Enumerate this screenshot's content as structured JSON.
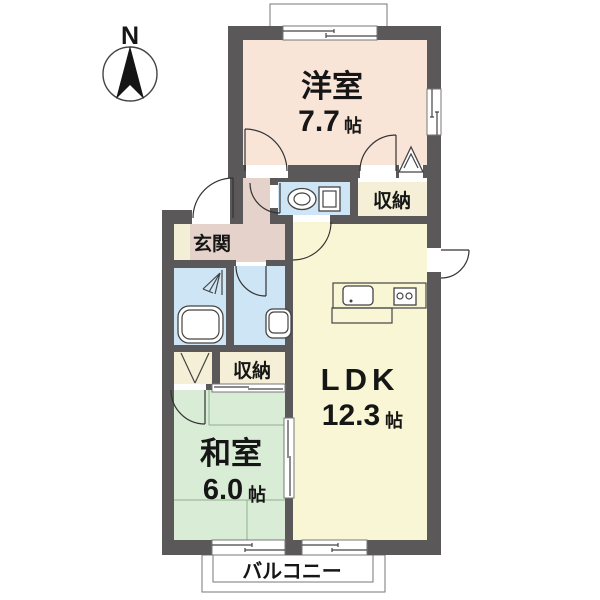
{
  "compass": {
    "label": "N"
  },
  "rooms": {
    "western": {
      "name": "洋室",
      "area": "7.7",
      "unit": "帖"
    },
    "ldk": {
      "name": "LDK",
      "area": "12.3",
      "unit": "帖"
    },
    "japanese": {
      "name": "和室",
      "area": "6.0",
      "unit": "帖"
    },
    "entrance": {
      "name": "玄関"
    },
    "storage_upper": {
      "name": "収納"
    },
    "storage_lower": {
      "name": "収納"
    },
    "balcony": {
      "name": "バルコニー"
    }
  },
  "colors": {
    "wall": "#5a5858",
    "western_room": "#f9e5d8",
    "hallway": "#e5d2ca",
    "entrance_step": "#f3eed6",
    "wet_area": "#cde5f4",
    "storage": "#f4efd6",
    "ldk": "#f8f6d5",
    "japanese_room": "#d9ecd5",
    "bathtub_fill": "#ddeffa",
    "fixture_fill": "#fffef5",
    "outline": "#333333"
  }
}
